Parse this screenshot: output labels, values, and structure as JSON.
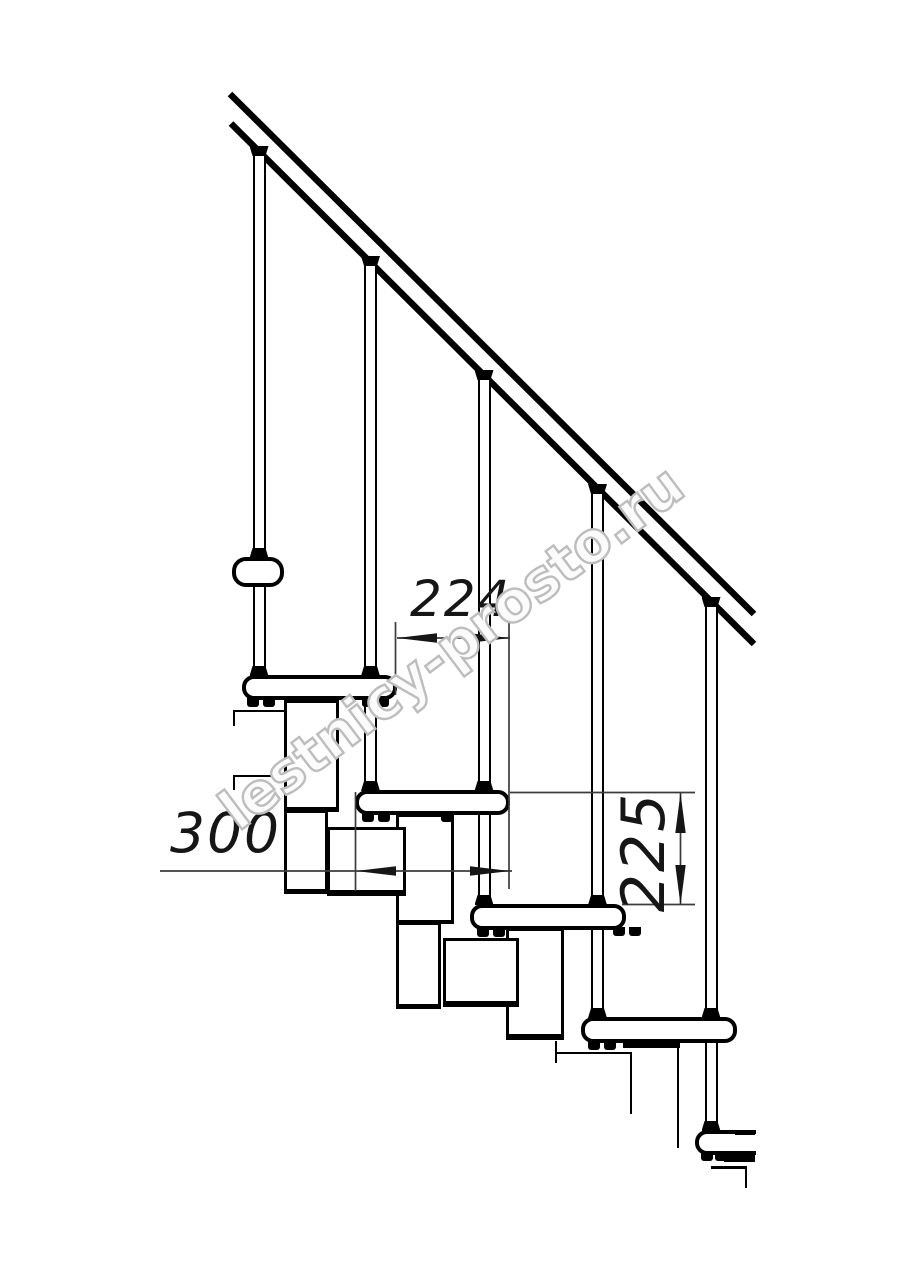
{
  "title": "Modular staircase side elevation drawing",
  "drawing": {
    "watermark": "lestnicy-prosto.ru",
    "dimensions": {
      "step_run": "224",
      "tread_depth": "300",
      "step_rise": "225"
    }
  },
  "colors": {
    "line": "#000000",
    "dimension_line": "#3c3c3c",
    "watermark_outline": "#bdbdbd",
    "background": "#ffffff"
  }
}
